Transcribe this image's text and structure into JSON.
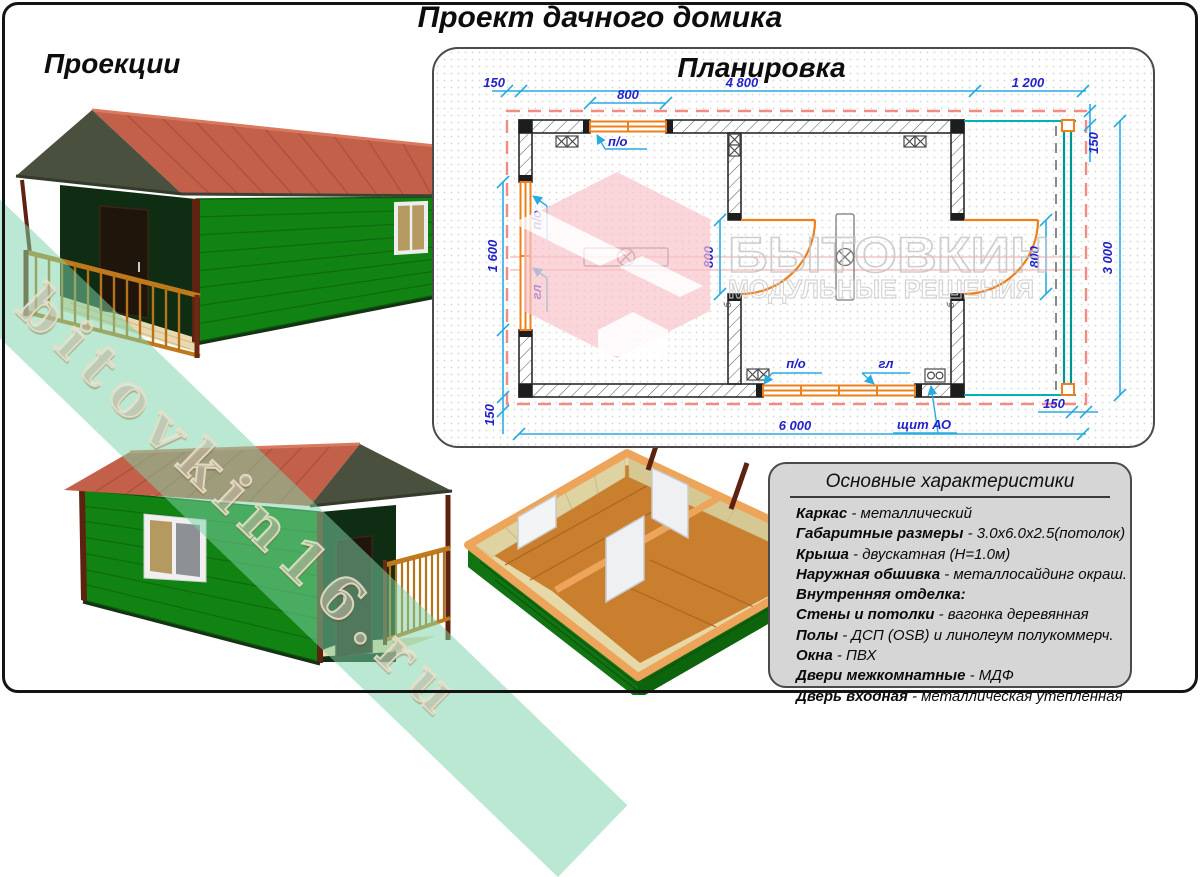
{
  "page": {
    "title": "Проект дачного домика"
  },
  "projections": {
    "heading": "Проекции"
  },
  "plan": {
    "heading": "Планировка",
    "dims": {
      "top_offset_left": "150",
      "top_window": "800",
      "top_main": "4 800",
      "top_veranda": "1 200",
      "top_right_offset": "150",
      "left_window": "1 600",
      "bottom_left_offset": "150",
      "door_interior": "800",
      "door_veranda": "800",
      "right_total": "3 000",
      "bottom_total": "6 000",
      "bottom_right_offset": "150"
    },
    "labels": {
      "po_top": "п/о",
      "po_left": "п/о",
      "gl_left": "гл",
      "po_bottom": "п/о",
      "gl_bottom": "гл",
      "panel": "щит АО",
      "door_mark": "б"
    },
    "watermark": {
      "line1": "БЫТОВКИН",
      "line2": "МОДУЛЬНЫЕ РЕШЕНИЯ"
    }
  },
  "characteristics": {
    "heading": "Основные характеристики",
    "items": [
      {
        "name": "Каркас",
        "value": "металлический"
      },
      {
        "name": "Габаритные размеры",
        "value": "3.0х6.0х2.5(потолок)"
      },
      {
        "name": "Крыша",
        "value": "двускатная (Н=1.0м)"
      },
      {
        "name": "Наружная обшивка",
        "value": "металлосайдинг окраш."
      },
      {
        "name": "Внутренняя отделка:",
        "value": ""
      },
      {
        "name": "Стены и потолки",
        "value": "вагонка деревянная"
      },
      {
        "name": "Полы",
        "value": "ДСП (OSB) и линолеум полукоммерч."
      },
      {
        "name": "Окна",
        "value": "ПВХ"
      },
      {
        "name": "Двери межкомнатные",
        "value": "МДФ"
      },
      {
        "name": "Дверь входная",
        "value": "металлическая утепленная"
      }
    ]
  },
  "watermark_band": {
    "text": "bitovkin16.ru"
  },
  "colors": {
    "wall_green": "#118312",
    "roof_red": "#c2604a",
    "gable_dark": "#49503d",
    "trim_brown": "#5e2310",
    "railing_gold": "#c07a1c",
    "plan_dim_line": "#29abe2",
    "plan_dim_text": "#2222cc",
    "plan_orange": "#ef7f1a",
    "plan_teal": "#009595",
    "plan_red_dash": "#f28b82",
    "panel_gray": "#d6d6d6"
  }
}
